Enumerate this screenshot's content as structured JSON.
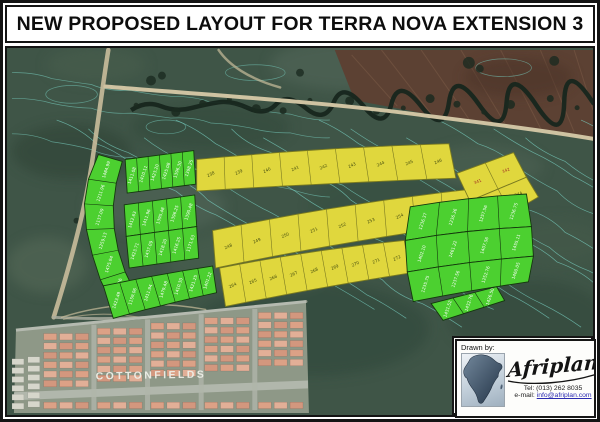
{
  "title": "NEW PROPOSED LAYOUT FOR TERRA NOVA EXTENSION 3",
  "map": {
    "area_label": "COTTONFIELDS",
    "colors": {
      "plot_green": "#4cd030",
      "plot_yellow": "#e0d73d",
      "contour": "#79d2c3",
      "field_brown": "#5c4133",
      "terrain": "#3f5547"
    },
    "plots": {
      "yellow_row_top": [
        "238",
        "239",
        "240",
        "241",
        "242",
        "243",
        "244",
        "245",
        "246"
      ],
      "yellow_row_middle": [
        "248",
        "249",
        "250",
        "251",
        "252",
        "253",
        "254",
        "255",
        "256",
        "257"
      ],
      "yellow_row_bottom": [
        "264",
        "265",
        "266",
        "267",
        "268",
        "269",
        "270",
        "271",
        "272"
      ],
      "yellow_block_corner": [
        "341",
        "342",
        "343",
        "344"
      ],
      "green_left_arc": [
        "1484.99",
        "1211.96",
        "1137.09",
        "1259.13",
        "1475.94",
        "1414.26"
      ],
      "green_left_top": [
        "1411.08",
        "1410.11",
        "1423.20",
        "1425.08",
        "1396.30",
        "1398.25"
      ],
      "green_left_mid_a": [
        "1412.63",
        "1411.96",
        "1395.48",
        "1396.25",
        "1390.48"
      ],
      "green_left_mid_b": [
        "1423.71",
        "1437.09",
        "1418.20",
        "1416.25",
        "1171.63"
      ],
      "green_left_bottom": [
        "1423.49",
        "1159.06",
        "1411.94",
        "1479.48",
        "1410.30",
        "1421.25",
        "1401.22"
      ],
      "green_right_row_a": [
        "1236.37",
        "1236.36",
        "1257.56",
        "1236.75"
      ],
      "green_right_row_b": [
        "1402.10",
        "1461.22",
        "1407.56",
        "1455.11"
      ],
      "green_right_row_c": [
        "1235.75",
        "1237.56",
        "1252.76",
        "1460.05"
      ],
      "green_right_tail": [
        "1431.52",
        "1432.76",
        "1426.50"
      ]
    }
  },
  "credit": {
    "drawn_by": "Drawn by:",
    "company": "Afriplan",
    "tel": "Tel:  (013) 262 8035",
    "email_label": "e-mail: ",
    "email": "info@afriplan.com"
  }
}
